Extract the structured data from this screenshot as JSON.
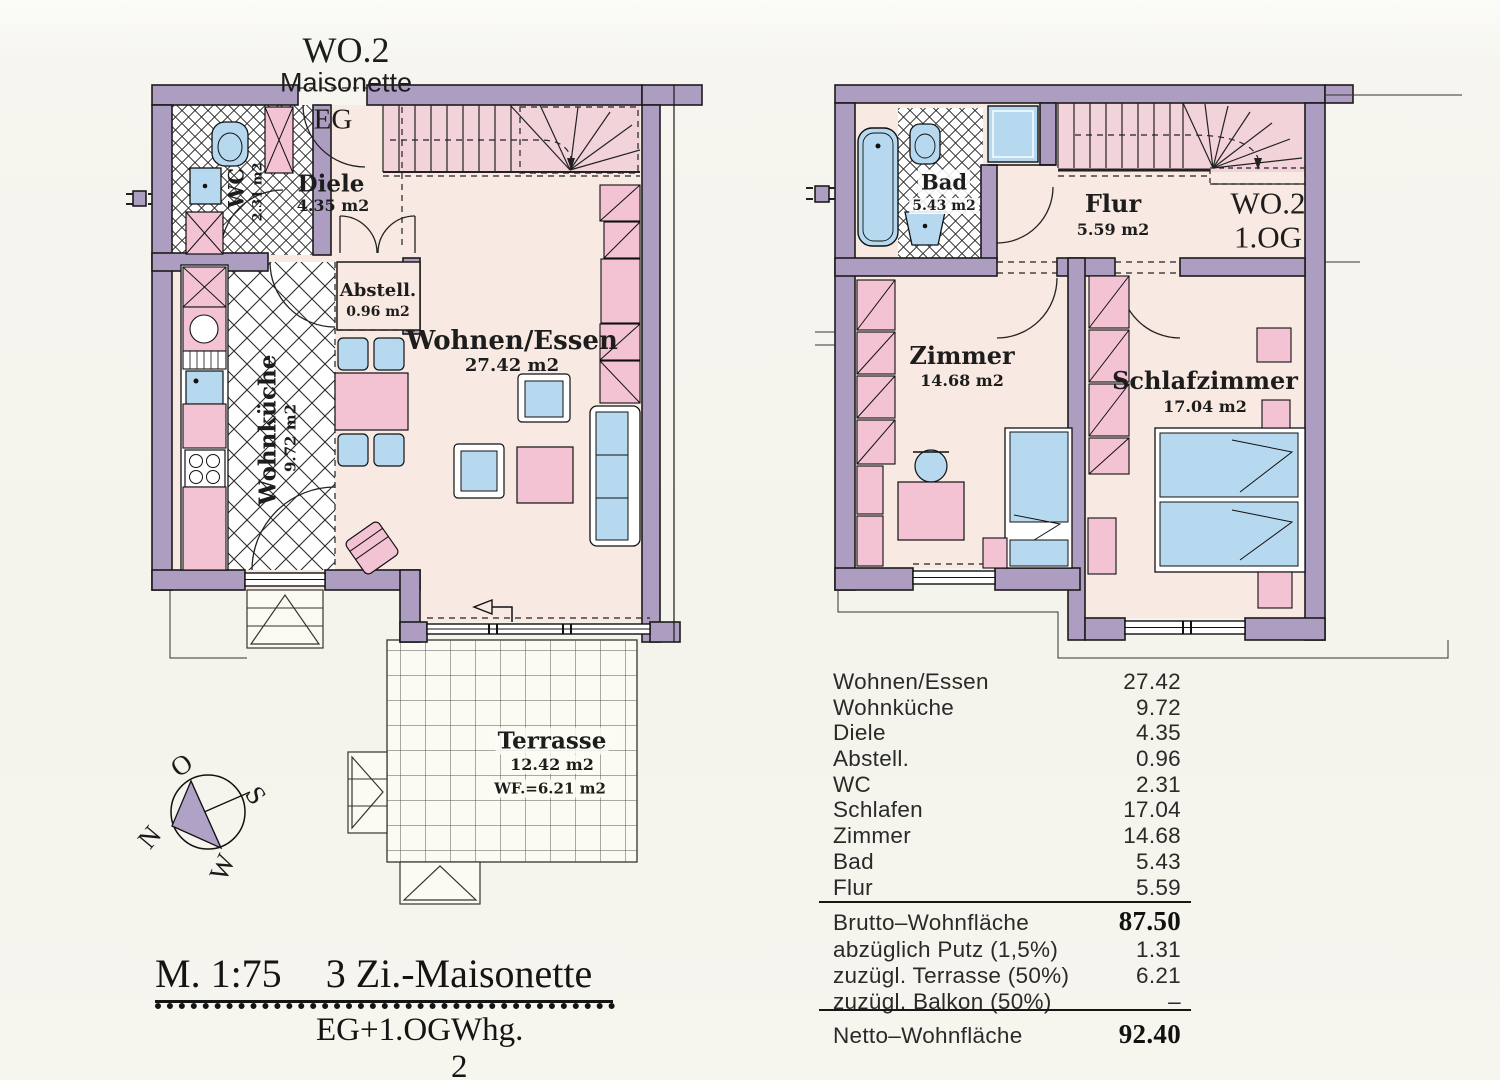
{
  "title": {
    "unit": "WO.2",
    "type": "Maisonette"
  },
  "plans": {
    "eg": {
      "floor_label": "EG",
      "rooms": {
        "diele": {
          "name": "Diele",
          "area": "4.35 m2"
        },
        "wc": {
          "name": "WC",
          "area": "2.31 m2"
        },
        "abstell": {
          "name": "Abstell.",
          "area": "0.96 m2"
        },
        "wohnen_essen": {
          "name": "Wohnen/Essen",
          "area": "27.42 m2"
        },
        "wohnkueche": {
          "name": "Wohnküche",
          "area": "9.72 m2"
        },
        "terrasse": {
          "name": "Terrasse",
          "area": "12.42 m2",
          "wf": "WF.=6.21 m2"
        }
      }
    },
    "og": {
      "unit_label": "WO.2",
      "floor_label": "1.OG",
      "rooms": {
        "bad": {
          "name": "Bad",
          "area": "5.43 m2"
        },
        "flur": {
          "name": "Flur",
          "area": "5.59 m2"
        },
        "zimmer": {
          "name": "Zimmer",
          "area": "14.68 m2"
        },
        "schlafzimmer": {
          "name": "Schlafzimmer",
          "area": "17.04 m2"
        }
      }
    }
  },
  "compass": {
    "north": "N",
    "east": "O",
    "south": "S",
    "west": "W"
  },
  "caption": {
    "scale": "M. 1:75",
    "title": "3 Zi.-Maisonette",
    "floors": "EG+1.OG",
    "unit": "Whg. 2"
  },
  "area_table": {
    "rows": [
      {
        "label": "Wohnen/Essen",
        "value": "27.42"
      },
      {
        "label": "Wohnküche",
        "value": "9.72"
      },
      {
        "label": "Diele",
        "value": "4.35"
      },
      {
        "label": "Abstell.",
        "value": "0.96"
      },
      {
        "label": "WC",
        "value": "2.31"
      },
      {
        "label": "Schlafen",
        "value": "17.04"
      },
      {
        "label": "Zimmer",
        "value": "14.68"
      },
      {
        "label": "Bad",
        "value": "5.43"
      },
      {
        "label": "Flur",
        "value": "5.59"
      }
    ],
    "brutto": {
      "label": "Brutto–Wohnfläche",
      "value": "87.50"
    },
    "adjustments": [
      {
        "label": "abzüglich Putz (1,5%)",
        "value": "1.31"
      },
      {
        "label": "zuzügl. Terrasse (50%)",
        "value": "6.21"
      },
      {
        "label": "zuzügl. Balkon (50%)",
        "value": "–"
      }
    ],
    "netto": {
      "label": "Netto–Wohnfläche",
      "value": "92.40"
    }
  },
  "colors": {
    "wall": "#ad9ec1",
    "furniture_pink": "#f3c3d4",
    "fixture_blue": "#b6d9ef",
    "floor": "#f8e9e2",
    "stair_floor": "#f3d3da",
    "background": "#f6f5ef"
  }
}
